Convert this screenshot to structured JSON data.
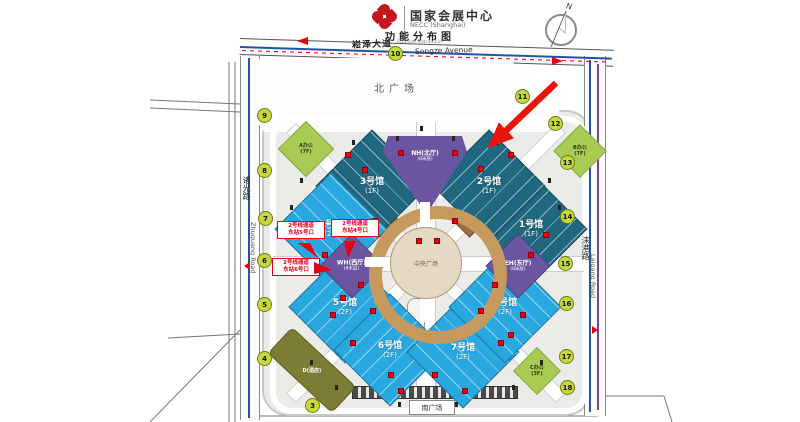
{
  "header": {
    "title_cn": "国家会展中心",
    "title_en": "NECC (Shanghai)",
    "subtitle_cn": "功能分布图",
    "subtitle_en": "Function distribution"
  },
  "compass": {
    "label": "N"
  },
  "roads": {
    "songze_cn": "崧泽大道",
    "songze_en": "Songze Avenue",
    "zhuguang_cn": "诸光路",
    "zhuguang_en": "Zhuguang Road",
    "laigang_cn": "涞港路",
    "laigang_en": "Laigang Road"
  },
  "plazas": {
    "north": "北广场",
    "south": "南广场",
    "central": "中央广场"
  },
  "halls": [
    {
      "name": "1号馆",
      "floor": "(1F)"
    },
    {
      "name": "2号馆",
      "floor": "(1F)"
    },
    {
      "name": "3号馆",
      "floor": "(1F)"
    },
    {
      "name": "4号馆",
      "floor": "(2F)"
    },
    {
      "name": "5号馆",
      "floor": "(2F)"
    },
    {
      "name": "6号馆",
      "floor": "(2F)"
    },
    {
      "name": "7号馆",
      "floor": "(2F)"
    },
    {
      "name": "8号馆",
      "floor": "(2F)"
    }
  ],
  "lobbies": {
    "north": {
      "name": "NH(北厅)",
      "sub": "(8米层)"
    },
    "west": {
      "name": "WH(西厅)",
      "sub": "(8米层)"
    },
    "east": {
      "name": "EH(东厅)",
      "sub": "(8米层)"
    }
  },
  "buildings": {
    "office_a": {
      "name": "A办公",
      "sub": "(7F)"
    },
    "office_b": {
      "name": "B办公",
      "sub": "(7F)"
    },
    "office_c": {
      "name": "C办公",
      "sub": "(3F)"
    },
    "hotel_d": {
      "name": "D(酒店)"
    }
  },
  "metro_callouts": [
    {
      "line1": "2号线通道",
      "line2": "东站5号口"
    },
    {
      "line1": "2号线通道",
      "line2": "东站4号口"
    },
    {
      "line1": "2号线通道",
      "line2": "东站6号口"
    }
  ],
  "gates": {
    "g3": "3",
    "g4": "4",
    "g5": "5",
    "g6": "6",
    "g7": "7",
    "g8": "8",
    "g9": "9",
    "g10": "10",
    "g11": "11",
    "g12": "12",
    "g13": "13",
    "g14": "14",
    "g15": "15",
    "g16": "16",
    "g17": "17",
    "g18": "18"
  },
  "colors": {
    "hall_dark": "#1f6880",
    "hall_light": "#29a8e0",
    "lobby_purple": "#6c55a0",
    "office_green": "#a8cc53",
    "hotel_olive": "#7c7c35",
    "gate_fill": "#c5d93d",
    "accent_red": "#e60012",
    "metro_blue": "#2155a3",
    "line_purple": "#7d3f98",
    "plaza_tan": "#c6995d"
  }
}
